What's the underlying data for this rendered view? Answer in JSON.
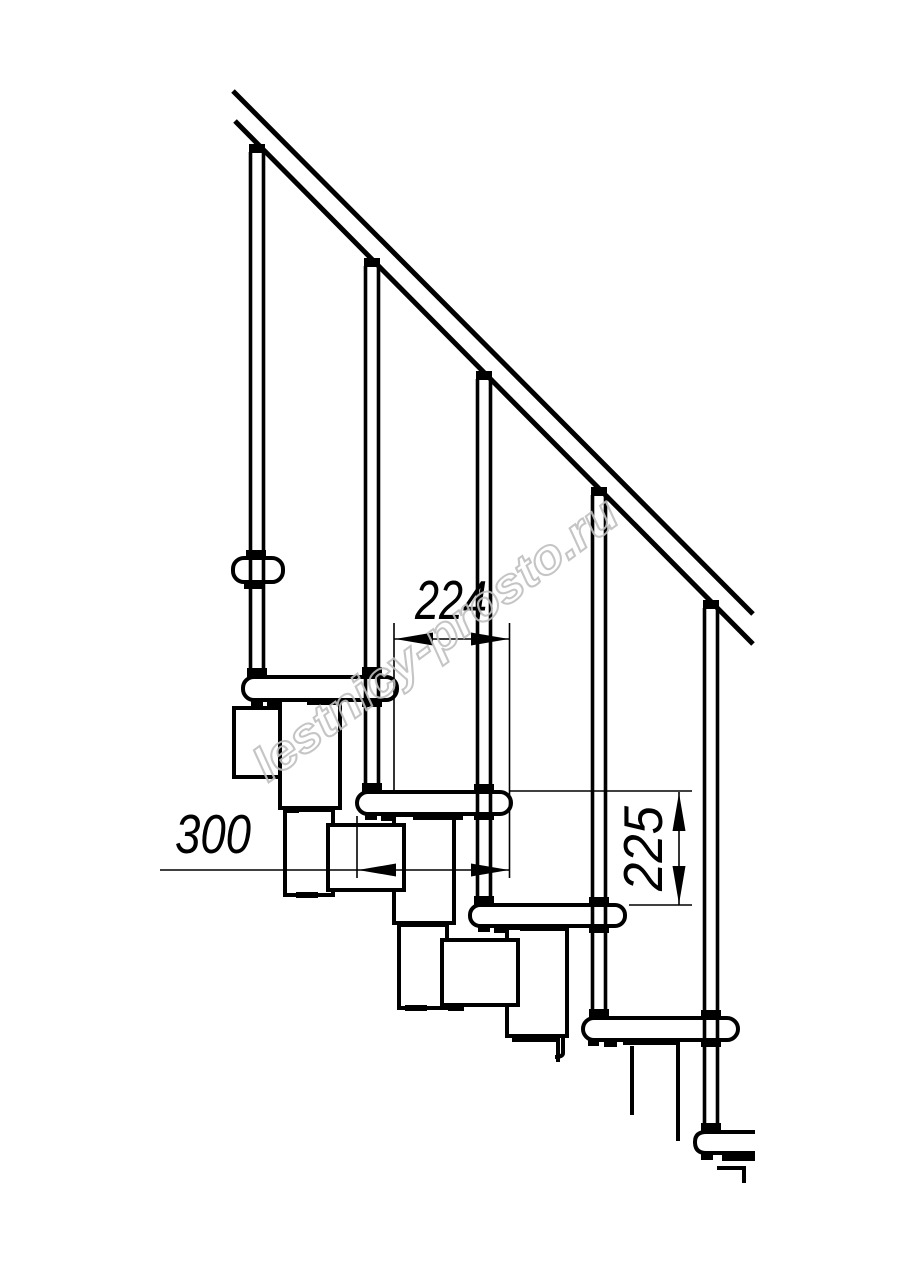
{
  "drawing": {
    "watermark_text": "lestnicy-prosto.ru",
    "dimension_labels": {
      "step_run": "224",
      "tread_depth": "300",
      "step_rise": "225"
    },
    "colors": {
      "line": "#000000",
      "dimension_text": "#000000",
      "watermark": "#bfbfbf",
      "background": "#ffffff"
    }
  }
}
